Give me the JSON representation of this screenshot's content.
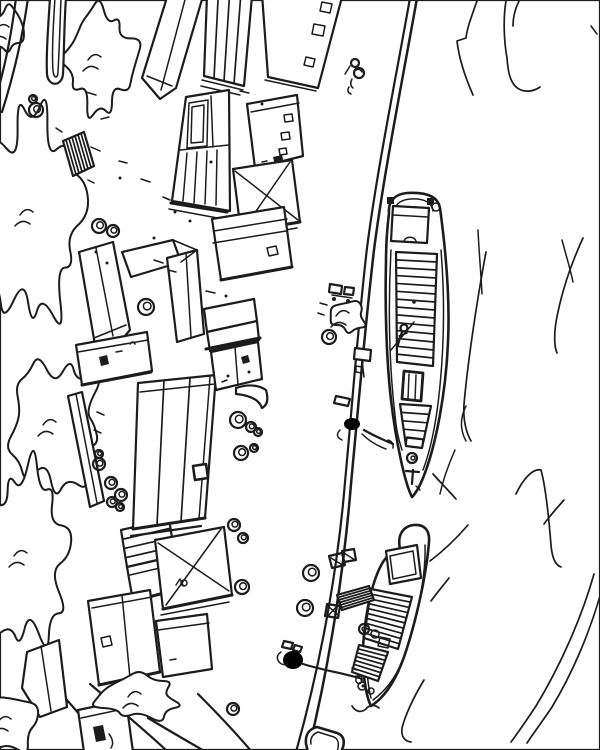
{
  "meta": {
    "title": "Aerial pen-and-ink sketch of a river quay with moored barges",
    "medium": "hand-drawn black ink line sketch on white paper",
    "ink": "#1c1c1c",
    "paper": "#ffffff"
  },
  "scene": {
    "description": "Bird's-eye view of a harbor quay: rows of warehouses, sheds and small houses on the left bank with trees along the far left edge, a long curving quay wall, one large cargo barge and one smaller barge moored in the river, a third boat partially visible at the bottom edge, barrels, crates, bollards with coiled mooring ropes, a gangplank, stone stairs, and sweeping water-current strokes on the right.",
    "left_bank": "dockyard with about fifteen buildings, stacked goods, barrels and figures",
    "right_side": "river water indicated by long curved strokes",
    "vessels": [
      "large cargo barge with planked hatch cover and stern cabin",
      "small cargo barge with cabin and two hatch covers",
      "partial boat at bottom edge"
    ]
  },
  "inventory": {
    "buildings": 15,
    "barges": 2,
    "partial_boats": 1,
    "barrels": 25,
    "crates": 3,
    "bollards_with_rope_coils": 2,
    "gangplanks": 1,
    "stairs": 1,
    "tree_clusters": 8,
    "figures": 2
  },
  "trees": [
    {
      "name": "canopy-upper",
      "layer": "back",
      "x": 100,
      "y": 60,
      "rx": 32,
      "ry": 50,
      "bumps": 20,
      "seed": 1
    },
    {
      "name": "tuft-top-corner",
      "layer": "back",
      "x": 8,
      "y": 30,
      "rx": 15,
      "ry": 22,
      "bumps": 12,
      "seed": 2
    },
    {
      "name": "canopy-left-large",
      "layer": "back",
      "x": 32,
      "y": 215,
      "rx": 46,
      "ry": 100,
      "bumps": 24,
      "seed": 3
    },
    {
      "name": "canopy-mid-left",
      "layer": "back",
      "x": 55,
      "y": 425,
      "rx": 44,
      "ry": 62,
      "bumps": 20,
      "seed": 4
    },
    {
      "name": "canopy-lower-left",
      "layer": "back",
      "x": 26,
      "y": 556,
      "rx": 40,
      "ry": 85,
      "bumps": 22,
      "seed": 5
    },
    {
      "name": "bush-bottom",
      "layer": "front",
      "x": 140,
      "y": 697,
      "rx": 42,
      "ry": 21,
      "bumps": 16,
      "seed": 6
    },
    {
      "name": "tuft-bottom-corner",
      "layer": "front",
      "x": 10,
      "y": 722,
      "rx": 26,
      "ry": 28,
      "bumps": 12,
      "seed": 7
    },
    {
      "name": "cargo-scrub-pile",
      "layer": "front",
      "x": 348,
      "y": 316,
      "rx": 17,
      "ry": 16,
      "bumps": 12,
      "seed": 8
    }
  ],
  "ladders": [
    {
      "name": "building-plank-roof",
      "layer": "early",
      "n": 3,
      "pts": [
        [
          207,
          -5
        ],
        [
          252,
          -4
        ],
        [
          244,
          86
        ],
        [
          204,
          76
        ]
      ]
    },
    {
      "name": "quay-stairs",
      "layer": "early",
      "n": 6,
      "pts": [
        [
          63,
          141
        ],
        [
          84,
          132
        ],
        [
          94,
          166
        ],
        [
          73,
          176
        ]
      ]
    },
    {
      "name": "shed-striped-roof",
      "layer": "early",
      "n": 3,
      "pts": [
        [
          121,
          530
        ],
        [
          127,
          567
        ],
        [
          175,
          556
        ],
        [
          169,
          519
        ]
      ]
    },
    {
      "name": "warehouse-long",
      "layer": "early",
      "n": 2,
      "pts": [
        [
          138,
          383
        ],
        [
          216,
          375
        ],
        [
          205,
          518
        ],
        [
          133,
          529
        ]
      ]
    },
    {
      "name": "barge-hatch-cover",
      "layer": "late",
      "n": 13,
      "pts": [
        [
          396,
          252
        ],
        [
          397,
          362
        ],
        [
          433,
          366
        ],
        [
          437,
          254
        ]
      ]
    },
    {
      "name": "barge-bow-deck-planks",
      "layer": "late",
      "n": 4,
      "pts": [
        [
          400,
          404
        ],
        [
          406,
          446
        ],
        [
          422,
          448
        ],
        [
          431,
          406
        ]
      ]
    },
    {
      "name": "boat-hatch-cover",
      "layer": "late",
      "n": 9,
      "pts": [
        [
          371,
          589
        ],
        [
          364,
          638
        ],
        [
          398,
          649
        ],
        [
          412,
          597
        ]
      ]
    },
    {
      "name": "boat-bow-hatch",
      "layer": "late",
      "n": 6,
      "pts": [
        [
          359,
          645
        ],
        [
          352,
          672
        ],
        [
          378,
          681
        ],
        [
          388,
          652
        ]
      ]
    },
    {
      "name": "gangplank",
      "layer": "late",
      "n": 5,
      "pts": [
        [
          337,
          595
        ],
        [
          342,
          610
        ],
        [
          374,
          600
        ],
        [
          369,
          586
        ]
      ]
    }
  ],
  "barrels": [
    [
      36,
      110,
      7
    ],
    [
      33,
      99,
      4
    ],
    [
      99,
      226,
      7
    ],
    [
      113,
      231,
      6
    ],
    [
      146,
      307,
      8
    ],
    [
      238,
      420,
      8
    ],
    [
      251,
      427,
      5
    ],
    [
      241,
      453,
      7
    ],
    [
      254,
      448,
      4
    ],
    [
      258,
      432,
      4
    ],
    [
      234,
      525,
      6
    ],
    [
      243,
      538,
      5
    ],
    [
      242,
      587,
      7
    ],
    [
      233,
      709,
      6
    ],
    [
      99,
      464,
      6
    ],
    [
      99,
      454,
      4
    ],
    [
      111,
      483,
      6
    ],
    [
      121,
      495,
      6
    ],
    [
      112,
      502,
      5
    ],
    [
      120,
      507,
      4
    ],
    [
      311,
      573,
      8
    ],
    [
      305,
      608,
      8
    ],
    [
      329,
      337,
      7
    ]
  ]
}
